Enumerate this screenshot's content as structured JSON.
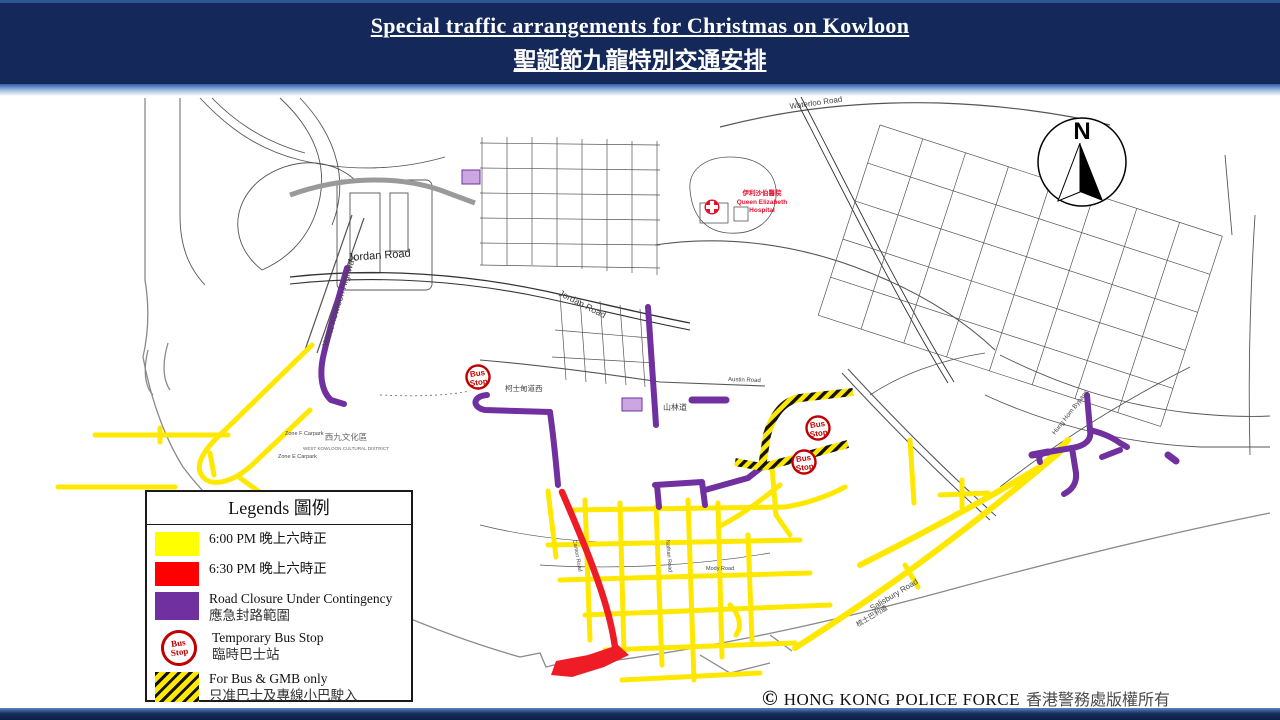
{
  "header": {
    "title_en": "Special traffic arrangements for Christmas on Kowloon",
    "title_zh": "聖誕節九龍特別交通安排",
    "bg_color": "#14295A",
    "accent_color": "#2E5FA8"
  },
  "legend": {
    "title": "Legends 圖例",
    "items": [
      {
        "color": "#FFFF00",
        "label": "6:00 PM 晚上六時正"
      },
      {
        "color": "#FF0000",
        "label": "6:30 PM 晚上六時正"
      },
      {
        "color": "#7030A0",
        "label_en": "Road Closure Under Contingency",
        "label_zh": "應急封路範圍"
      },
      {
        "icon": "bus-stop",
        "label_en": "Temporary Bus Stop",
        "label_zh": "臨時巴士站"
      },
      {
        "icon": "hatched",
        "label_en": "For Bus & GMB only",
        "label_zh": "只准巴士及專線小巴駛入"
      }
    ]
  },
  "map": {
    "compass_label": "N",
    "bus_stop": {
      "line1": "Bus",
      "line2": "Stop"
    },
    "road_colors": {
      "yellow_6pm": "#FFE800",
      "red_630pm": "#EE1C25",
      "purple_contingency": "#7030A0"
    },
    "labels": {
      "west_kowloon_highway": "West Kowloon Highway",
      "jordan_road": "Jordan Road",
      "waterloo_road": "Waterloo Road",
      "austin_road": "Austin Road",
      "austin_road_west": "柯士甸道西",
      "hillwood_road": "山林道",
      "canton_road": "Canton Road",
      "nathan_road": "Nathan Road",
      "mody_road": "Mody Road",
      "salisbury_road_en": "Salisbury Road",
      "salisbury_road_zh": "梳士巴利道",
      "hung_hom_bypass": "Hung Hom Bypass",
      "wkcd_zh": "西九文化區",
      "wkcd_en": "WEST KOWLOON CULTURAL DISTRICT",
      "zone_f_carpark": "Zone F Carpark",
      "zone_e_carpark": "Zone E Carpark",
      "hospital_zh": "伊利沙伯醫院",
      "hospital_en1": "Queen Elizabeth",
      "hospital_en2": "Hospital"
    }
  },
  "footer": {
    "copyright_symbol": "©",
    "text_en": "HONG KONG POLICE FORCE",
    "text_zh": "香港警務處版權所有"
  }
}
